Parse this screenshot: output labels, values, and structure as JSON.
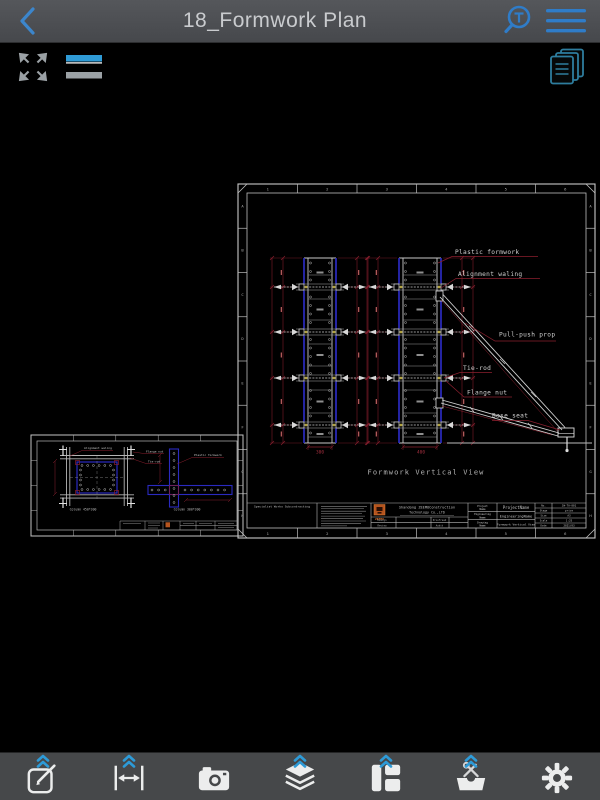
{
  "nav": {
    "title": "18_Formwork Plan"
  },
  "drawing": {
    "sheet": {
      "zone_numbers": [
        "1",
        "2",
        "3",
        "4",
        "5",
        "6"
      ],
      "zone_letters": [
        "A",
        "B",
        "C",
        "D",
        "E",
        "F",
        "G",
        "H"
      ],
      "view_title": "Formwork Vertical View",
      "annotations": {
        "plastic": "Plastic formwork",
        "waling": "Alignment waling",
        "prop": "Pull-push prop",
        "tierod": "Tie-rod",
        "flange": "Flange nut",
        "base": "Base seat"
      },
      "dims": {
        "col1": "300",
        "col2": "400"
      },
      "title_block": {
        "subcontract": "Specialist Works Subcontracting",
        "company_line1": "Shandong ZEEMOConstruction",
        "company_line2": "Technology Co.,LTD",
        "logo_text": "ZEEMO",
        "sign_labels": [
          "Design",
          "Review",
          "Proofread",
          "Audit"
        ],
        "fields": [
          {
            "label": "Project Name",
            "value": "ProjectName"
          },
          {
            "label": "Engineering Name",
            "value": "EngineeringName"
          },
          {
            "label": "Drawing Name",
            "value": "Formwork Vertical View"
          }
        ],
        "meta": [
          {
            "label": "No.",
            "value": "JW-TA-001"
          },
          {
            "label": "Stage",
            "value": "price"
          },
          {
            "label": "Size",
            "value": "A3"
          },
          {
            "label": "Scale",
            "value": "1:25"
          },
          {
            "label": "Date",
            "value": "2021/03"
          }
        ]
      }
    },
    "detail_sheet": {
      "annotations": {
        "waling": "Alignment waling",
        "flange": "Flange nut",
        "tierod": "Tie-rod",
        "plastic": "Plastic formwork"
      },
      "captions": [
        "Column 450*300",
        "Column 300*300"
      ]
    }
  },
  "icons": {
    "back": "back-chevron",
    "find_text": "text-search-magnifier",
    "menu": "hamburger-menu",
    "fit": "fit-to-screen-arrows",
    "linewidth": "line-thickness-bars",
    "sheets": "stacked-sheets",
    "footer": [
      "pencil-square",
      "measure-distance",
      "camera",
      "layers",
      "layout-blocks",
      "toolbox",
      "gear"
    ]
  },
  "colors": {
    "accent_blue": "#2f7cc8",
    "chevron_blue": "#2d9bd8",
    "cad_red": "#8a1f2e",
    "cad_blue": "#2a2ac0",
    "logo_orange": "#b5541e"
  }
}
